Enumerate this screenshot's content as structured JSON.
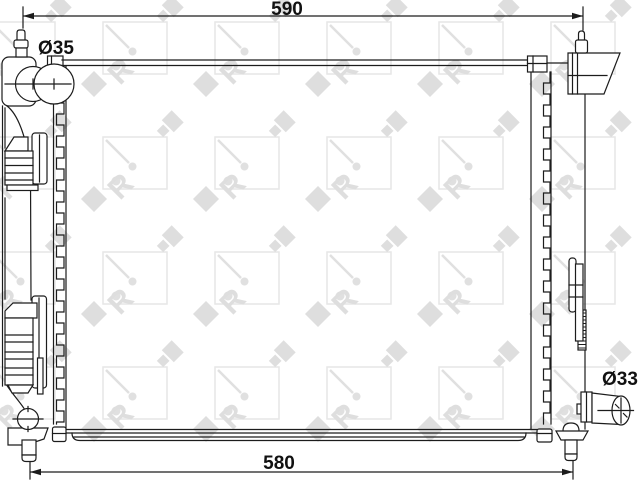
{
  "diagram": {
    "type": "technical-drawing",
    "subject": "radiator front view with mounting brackets and hose connections",
    "dimensions": {
      "top_width": "590",
      "bottom_width": "580",
      "inlet_diameter": "Ø35",
      "outlet_diameter": "Ø33"
    },
    "watermark": {
      "brand": "NRF",
      "letter_r": "R"
    },
    "colors": {
      "line": "#1c1c1c",
      "watermark": "#dedede",
      "background": "#ffffff"
    }
  }
}
